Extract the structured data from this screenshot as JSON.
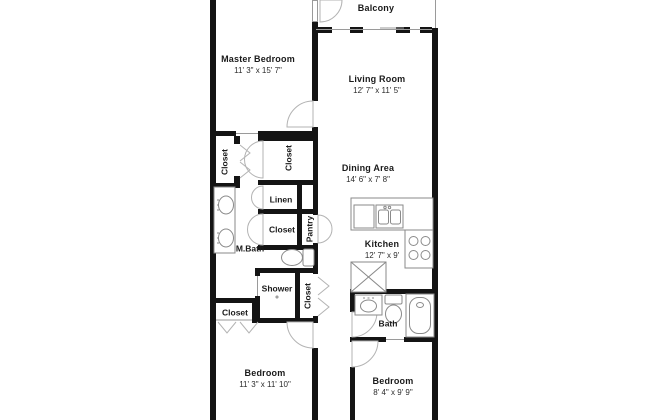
{
  "plan": {
    "title": "Apartment floor plan",
    "colors": {
      "wall": "#141414",
      "fixture": "#8a8a8a",
      "door": "#b3b3b3",
      "text": "#1a1a1a"
    },
    "rooms": {
      "balcony": {
        "name": "Balcony"
      },
      "master_bedroom": {
        "name": "Master Bedroom",
        "dims": "11' 3\" x 15' 7\""
      },
      "living_room": {
        "name": "Living Room",
        "dims": "12' 7\" x 11' 5\""
      },
      "dining_area": {
        "name": "Dining Area",
        "dims": "14' 6\" x 7' 8\""
      },
      "kitchen": {
        "name": "Kitchen",
        "dims": "12' 7\" x 9'"
      },
      "master_bath": {
        "name": "M.Bath"
      },
      "bath": {
        "name": "Bath"
      },
      "shower": {
        "name": "Shower"
      },
      "linen": {
        "name": "Linen"
      },
      "pantry": {
        "name": "Pantry"
      },
      "bedroom_1": {
        "name": "Bedroom",
        "dims": "11' 3\" x 11' 10\""
      },
      "bedroom_2": {
        "name": "Bedroom",
        "dims": "8' 4\" x 9' 9\""
      },
      "closet_master_hall": {
        "name": "Closet"
      },
      "closet_core": {
        "name": "Closet"
      },
      "closet_mbath": {
        "name": "Closet"
      },
      "closet_shower": {
        "name": "Closet"
      },
      "closet_bedroom_1": {
        "name": "Closet"
      }
    }
  }
}
